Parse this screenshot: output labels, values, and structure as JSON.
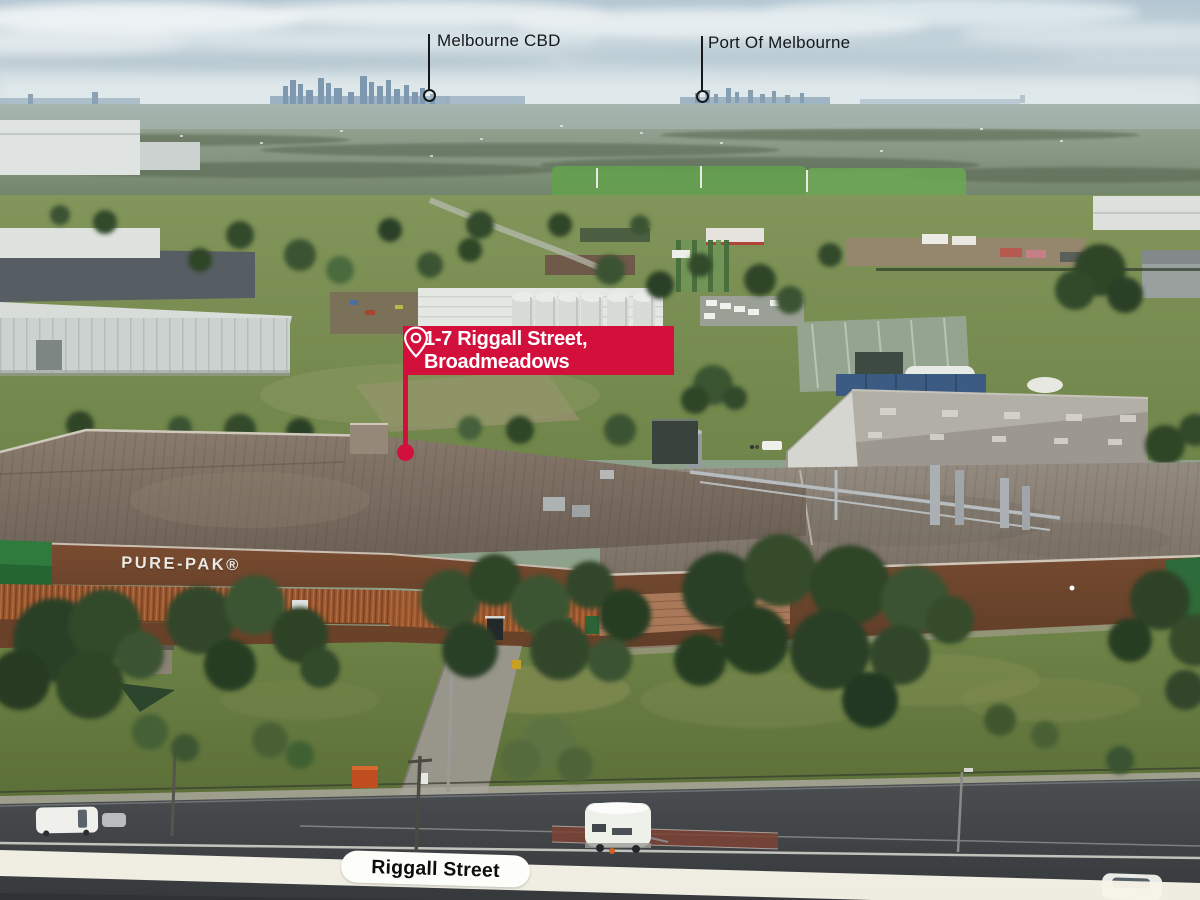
{
  "scene": {
    "building_sign": "PURE-PAK®"
  },
  "skyline_labels": {
    "cbd": "Melbourne CBD",
    "port": "Port Of Melbourne"
  },
  "address_callout": {
    "line1": "1-7 Riggall Street,",
    "line2": "Broadmeadows"
  },
  "street_label": "Riggall Street",
  "colors": {
    "callout_red": "#d30f3c",
    "label_color": "#15181a",
    "pill_bg": "#fdfdfa",
    "sign_color": "#ece9e3"
  }
}
